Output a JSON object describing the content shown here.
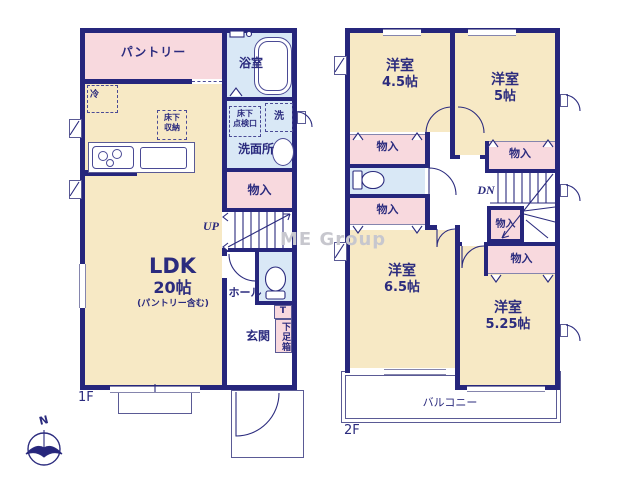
{
  "watermark": "ME Group",
  "compass": {
    "north": "N"
  },
  "colors": {
    "wall": "#26267c",
    "room_cream": "#f7e9c5",
    "closet_pink": "#f8d9de",
    "wet_blue": "#d9e8f6",
    "text_navy": "#2b2b7e"
  },
  "floor1": {
    "label": "1F",
    "pantry": "パントリー",
    "bath": "浴室",
    "refrigerator": "冷",
    "underfloor_storage_line1": "床下",
    "underfloor_storage_line2": "収納",
    "underfloor_hatch_line1": "床下",
    "underfloor_hatch_line2": "点検口",
    "washer": "洗",
    "washroom": "洗面所",
    "closet": "物入",
    "stairs_up": "UP",
    "hall": "ホール",
    "toilet_mark": "T",
    "shoe_box": "下足箱",
    "entrance": "玄関",
    "ldk_name": "LDK",
    "ldk_size": "20帖",
    "ldk_note": "(パントリー含む)"
  },
  "floor2": {
    "label": "2F",
    "room_45_name": "洋室",
    "room_45_size": "4.5帖",
    "room_5_name": "洋室",
    "room_5_size": "5帖",
    "room_65_name": "洋室",
    "room_65_size": "6.5帖",
    "room_525_name": "洋室",
    "room_525_size": "5.25帖",
    "closet": "物入",
    "stairs_down": "DN",
    "balcony": "バルコニー"
  }
}
